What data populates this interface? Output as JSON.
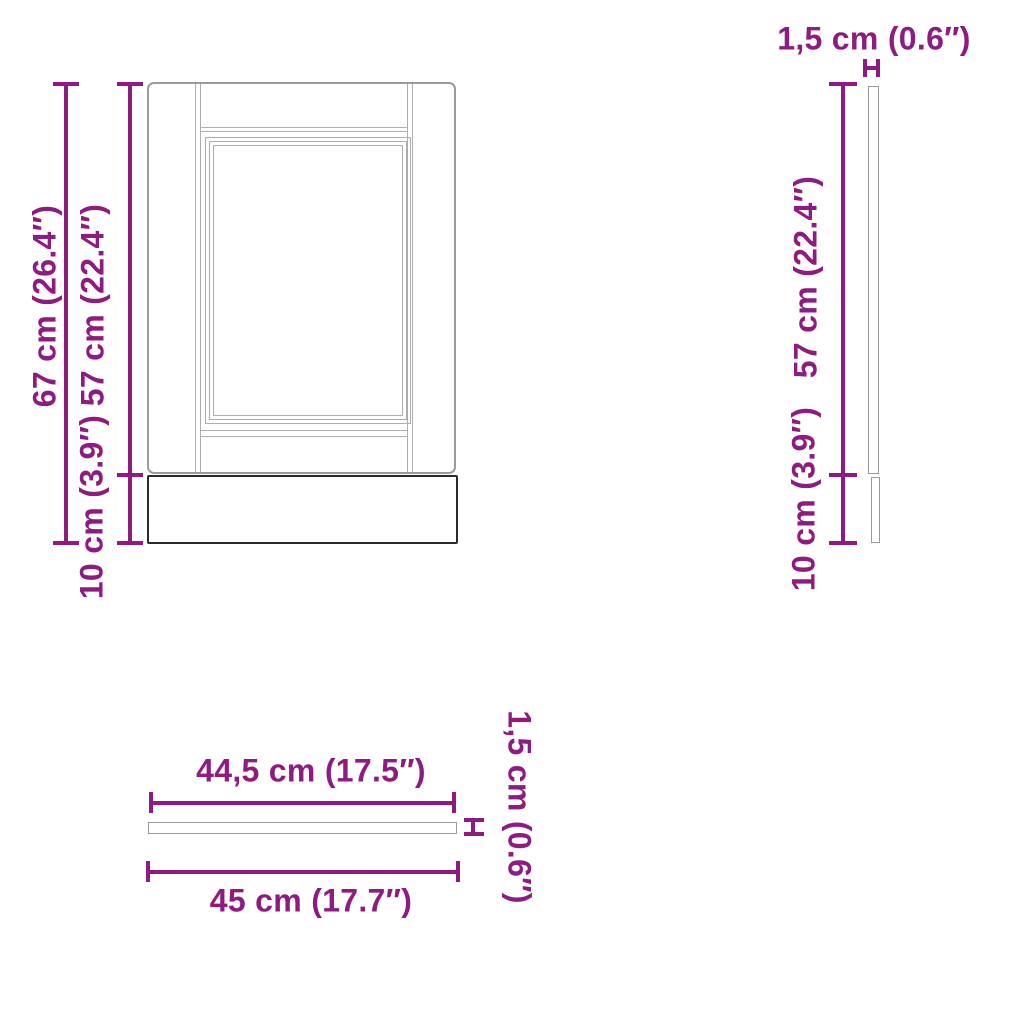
{
  "colors": {
    "accent": "#8f1a80",
    "outline": "#9b9b9b",
    "panel_line": "#aeaeae",
    "plinth_border": "#2b2b2b"
  },
  "front_view": {
    "total_height": "67 cm (26.4″)",
    "door_height": "57 cm (22.4″)",
    "plinth_height": "10 cm (3.9″)"
  },
  "side_view": {
    "thickness": "1,5 cm (0.6″)",
    "door_height": "57 cm (22.4″)",
    "plinth_height": "10 cm (3.9″)"
  },
  "top_view": {
    "front_width": "44,5 cm (17.5″)",
    "total_width": "45 cm (17.7″)",
    "thickness": "1,5 cm (0.6″)"
  }
}
